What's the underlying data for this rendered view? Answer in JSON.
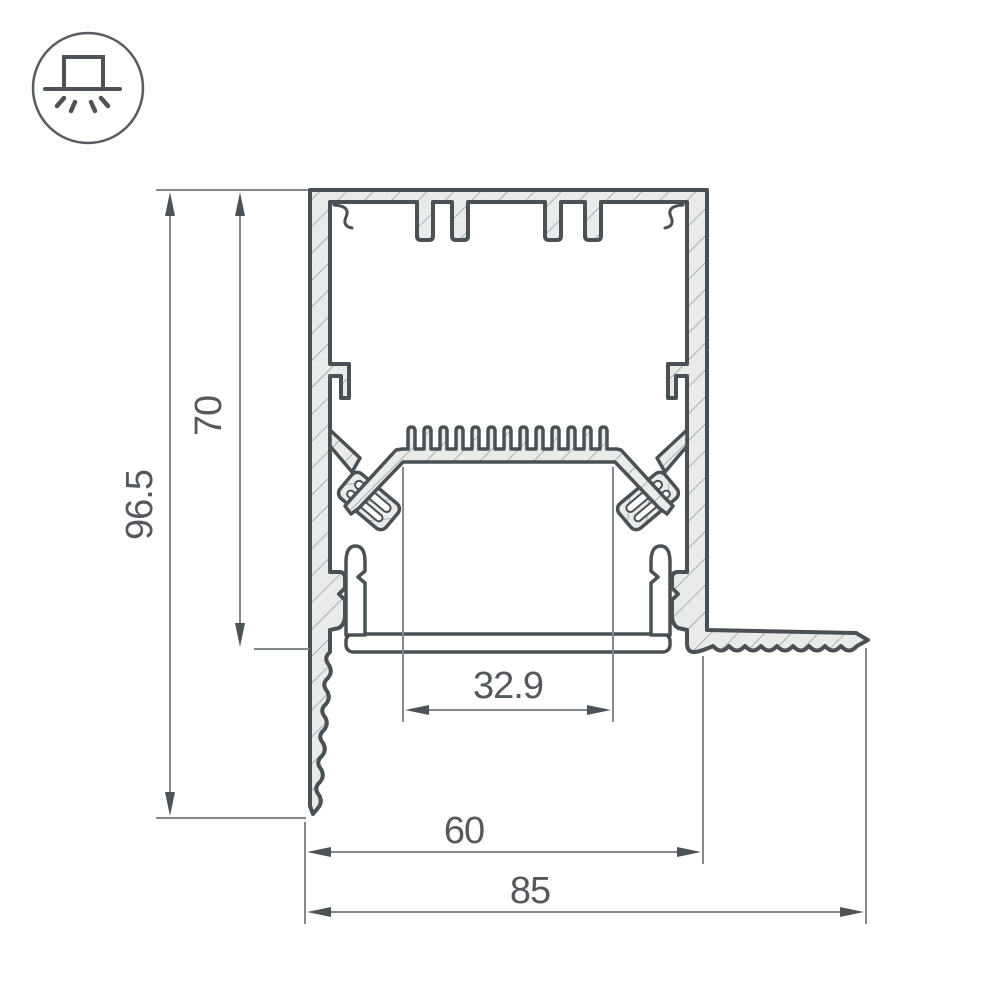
{
  "drawing": {
    "title": "LED profile cross-section, recessed mount",
    "icon": {
      "name": "recessed-mount-luminaire",
      "style": "square fixture on ceiling line with downward light rays"
    },
    "dimensions": {
      "total_height": "96.5",
      "visible_height": "70",
      "inner_width": "32.9",
      "body_width": "60",
      "overall_width": "85"
    },
    "colors": {
      "background": "#ffffff",
      "outline": "#4a5053",
      "aluminum_fill": "#e9ebea",
      "hatch_line": "#9aa0a4",
      "dimension_line": "#85898d",
      "dimension_text": "#55595e",
      "diffuser_fill": "#ffffff"
    }
  }
}
